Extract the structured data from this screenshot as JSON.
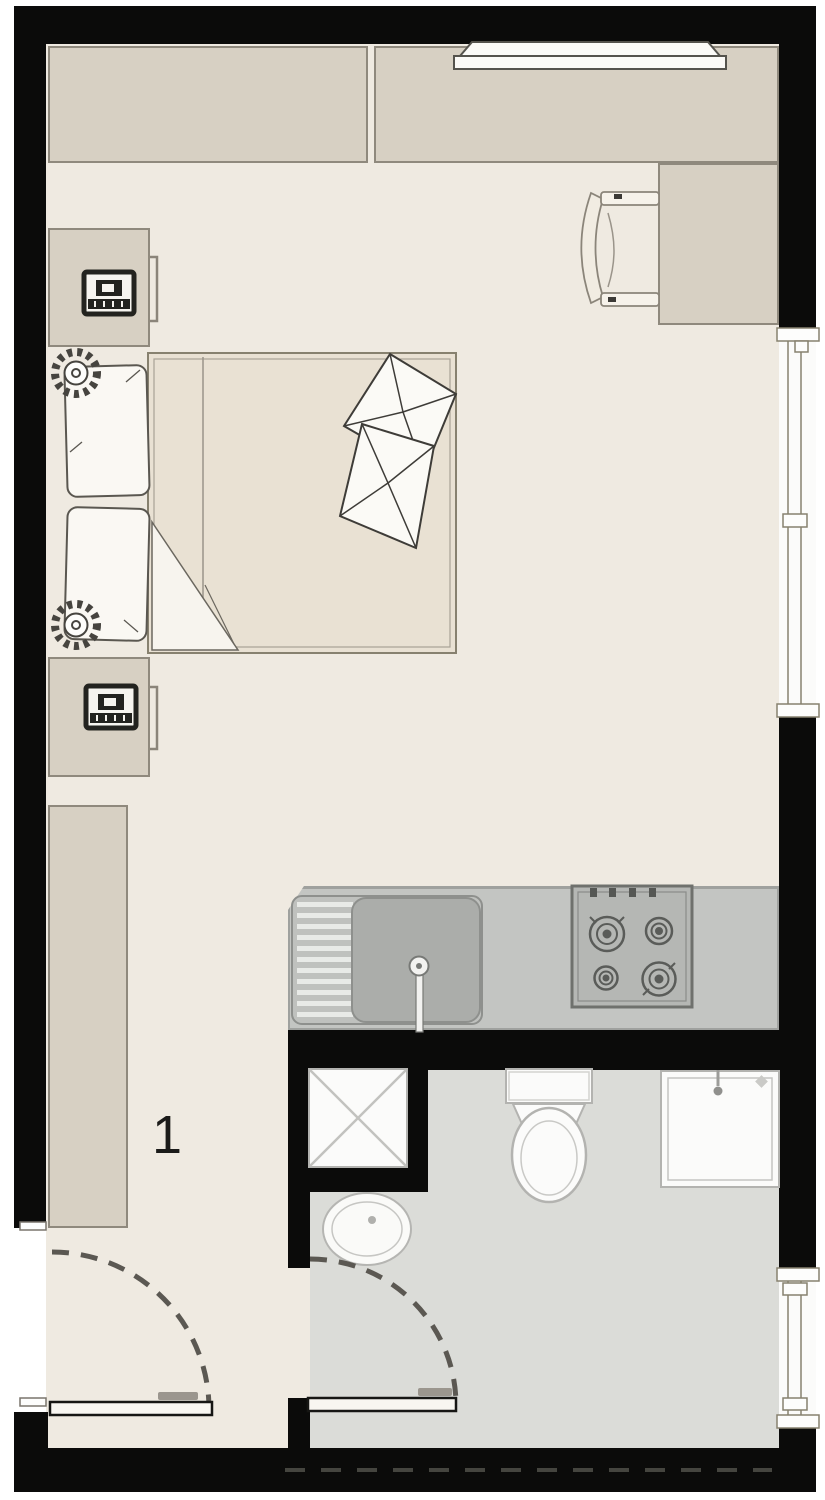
{
  "plan": {
    "unit_label": "1",
    "description": "studio apartment floor plan, plan view"
  },
  "colors": {
    "wall": "#0b0b0a",
    "floor": "#efeae1",
    "bath_floor": "#dbdcd8",
    "cabinet": "#d7d0c3",
    "cabinet_border": "#8f897d",
    "mattress": "#e9e1d3",
    "counter": "#c3c5c2",
    "counter_border": "#9fa19e",
    "fixture": "#fbfbfa",
    "fixture_line": "#b3b3b0",
    "sketch": "#55524c",
    "page": "#ffffff"
  },
  "elements": {
    "furniture": [
      "wardrobe-top-left",
      "wardrobe-top-right",
      "tv-on-cabinet",
      "desk",
      "chair",
      "nightstand-top",
      "nightstand-bottom",
      "double-bed",
      "head-pillows",
      "decor-pillows",
      "blanket-fold",
      "closet-left",
      "plant-top",
      "plant-bottom"
    ],
    "kitchen": [
      "kitchen-counter",
      "sink-drainboard",
      "sink-basin",
      "faucet",
      "cooktop-4-burners"
    ],
    "bathroom": [
      "duct-shaft",
      "vanity-sink",
      "toilet",
      "shower-box",
      "shower-head"
    ],
    "openings": [
      "entry-door-left-wall",
      "bathroom-door",
      "window-right-upper",
      "window-right-lower"
    ]
  }
}
